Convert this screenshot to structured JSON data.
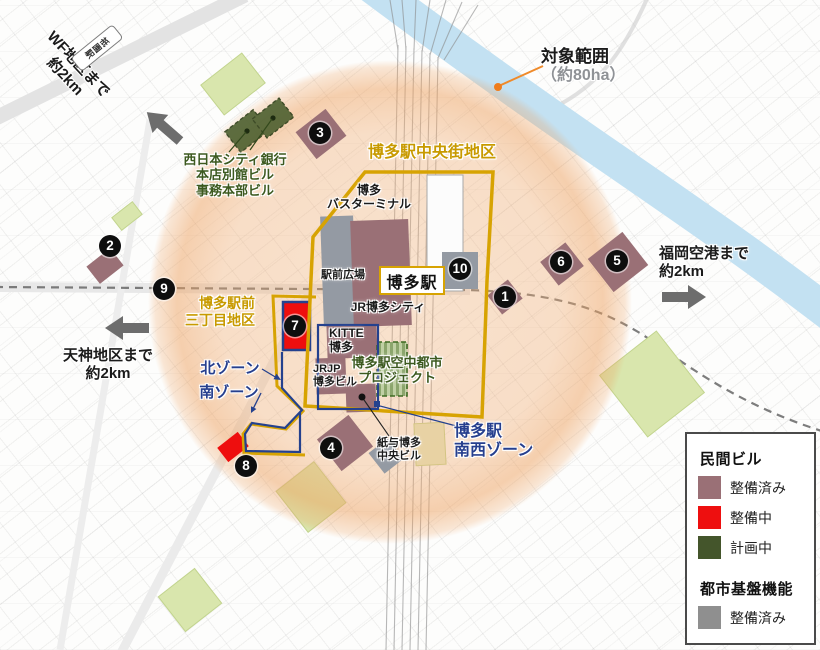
{
  "annotations": {
    "wf_note": [
      "WF地区まで",
      "約2km"
    ],
    "tenjin_note": [
      "天神地区まで",
      "約2km"
    ],
    "airport_note": [
      "福岡空港まで",
      "約2km"
    ],
    "target_area": {
      "title": "対象範囲",
      "subtitle": "（約80ha）"
    }
  },
  "stations": {
    "hakata": "博多駅",
    "gion": "祇園駅"
  },
  "districts": {
    "chuogai": "博多駅中央街地区",
    "sanchome": [
      "博多駅前",
      "三丁目地区"
    ],
    "kita_zone": "北ゾーン",
    "minami_zone": "南ゾーン",
    "nansei_zone": [
      "博多駅",
      "南西ゾーン"
    ]
  },
  "buildings": {
    "bank": [
      "西日本シティ銀行",
      "本店別館ビル",
      "事務本部ビル"
    ],
    "bus_terminal": [
      "博多",
      "バスターミナル"
    ],
    "ekimae_hiroba": "駅前広場",
    "jr_hakata_city": "JR博多シティ",
    "kitte": [
      "KITTE",
      "博多"
    ],
    "jrjp": [
      "JRJP",
      "博多ビル"
    ],
    "kuchu_project": [
      "博多駅空中都市",
      "プロジェクト"
    ],
    "kamiyo": [
      "紙与博多",
      "中央ビル"
    ]
  },
  "markers": [
    {
      "n": "1",
      "x": 505,
      "y": 297
    },
    {
      "n": "2",
      "x": 110,
      "y": 246
    },
    {
      "n": "3",
      "x": 320,
      "y": 133
    },
    {
      "n": "4",
      "x": 331,
      "y": 448
    },
    {
      "n": "5",
      "x": 617,
      "y": 261
    },
    {
      "n": "6",
      "x": 561,
      "y": 262
    },
    {
      "n": "7",
      "x": 295,
      "y": 326
    },
    {
      "n": "8",
      "x": 246,
      "y": 466
    },
    {
      "n": "9",
      "x": 164,
      "y": 289
    },
    {
      "n": "10",
      "x": 460,
      "y": 269
    }
  ],
  "legend": {
    "sections": [
      {
        "title": "民間ビル",
        "items": [
          {
            "label": "整備済み",
            "color": "#9a7076"
          },
          {
            "label": "整備中",
            "color": "#ee0f0f"
          },
          {
            "label": "計画中",
            "color": "#44552b"
          }
        ]
      },
      {
        "title": "都市基盤機能",
        "items": [
          {
            "label": "整備済み",
            "color": "#8f8f8f"
          }
        ]
      }
    ]
  },
  "colors": {
    "boundary_gold": "#d7a302",
    "zone_navy": "#263f8e",
    "target_orange": "#ef7d1d",
    "circle_fill": "#f0ab70",
    "river_blue": "#c3e1f2",
    "park_green": "#d9e6ad"
  }
}
